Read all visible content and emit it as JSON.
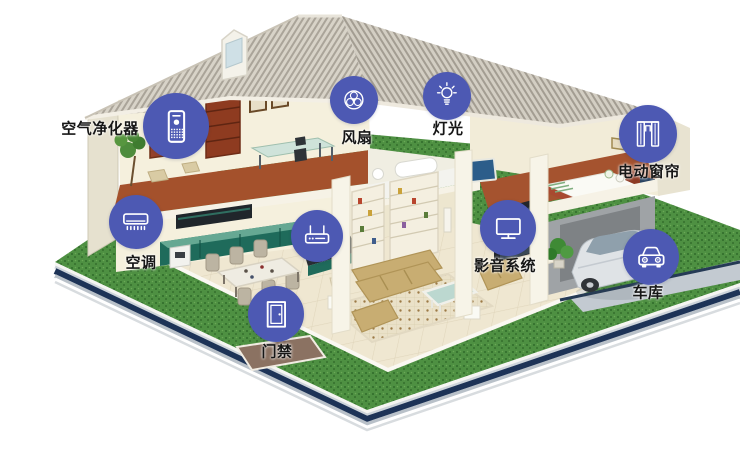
{
  "scene": {
    "type": "smart-home-cutaway-diagram",
    "background": "#ffffff"
  },
  "colors": {
    "accent": "#4d59b3",
    "icon_glyph": "#ffffff",
    "label_text": "#161616",
    "lawn_green": "#4e9042",
    "roof_gray": "#d7d2c7",
    "platform_navy": "#1d3357",
    "wall_cream": "#f5f0dd",
    "floor_brown": "#a4512c",
    "cabinet_teal": "#1f6b5b",
    "sofa_tan": "#c8ad72"
  },
  "devices": [
    {
      "id": "air_purifier",
      "label": "空气净化器",
      "icon": "air-purifier-icon",
      "label_side": "left"
    },
    {
      "id": "fan",
      "label": "风扇",
      "icon": "fan-icon",
      "label_side": "below"
    },
    {
      "id": "light",
      "label": "灯光",
      "icon": "light-bulb-icon",
      "label_side": "below"
    },
    {
      "id": "curtain",
      "label": "电动窗帘",
      "icon": "curtain-icon",
      "label_side": "below"
    },
    {
      "id": "ac",
      "label": "空调",
      "icon": "air-conditioner-icon",
      "label_side": "below"
    },
    {
      "id": "router",
      "label": "",
      "icon": "router-icon",
      "label_side": "none"
    },
    {
      "id": "av_system",
      "label": "影音系统",
      "icon": "tv-icon",
      "label_side": "below"
    },
    {
      "id": "door_access",
      "label": "门禁",
      "icon": "door-icon",
      "label_side": "below"
    },
    {
      "id": "garage",
      "label": "车库",
      "icon": "car-icon",
      "label_side": "below"
    }
  ]
}
